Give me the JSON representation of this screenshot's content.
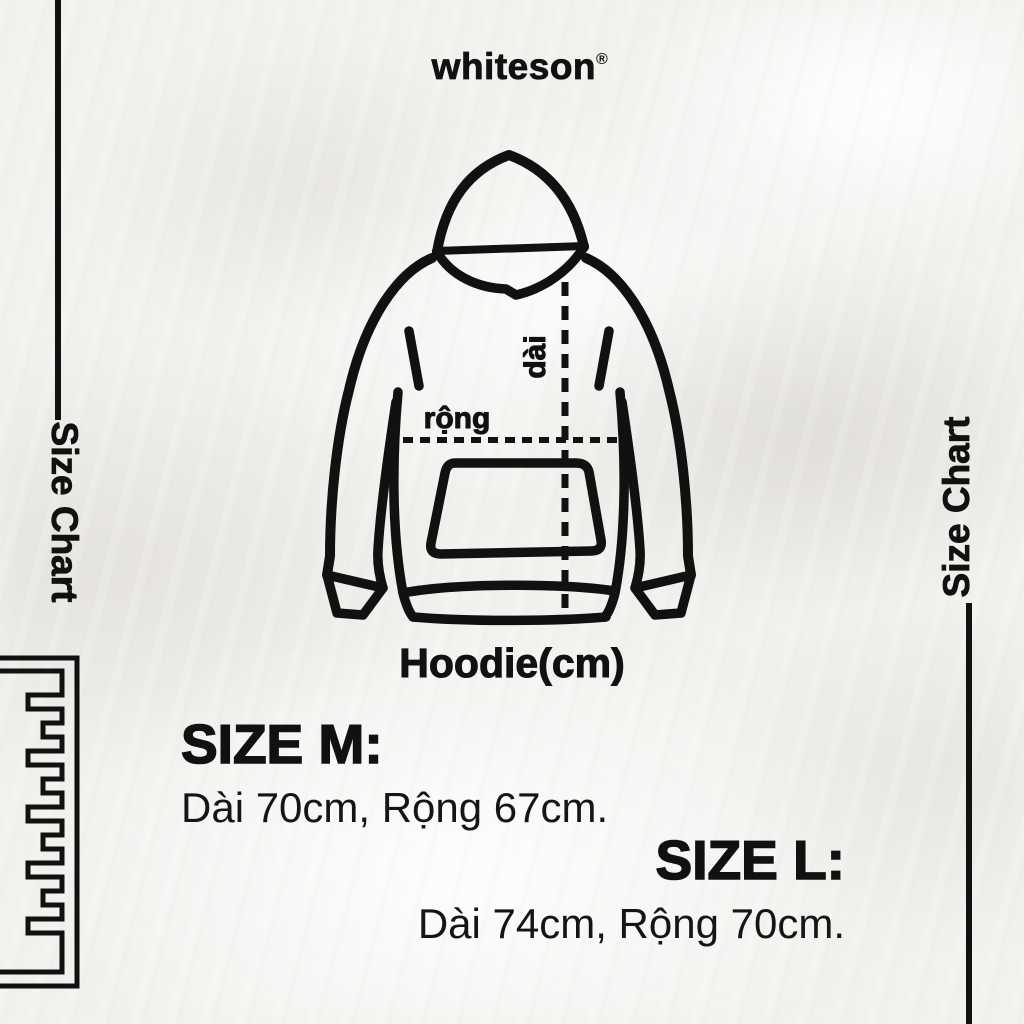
{
  "brand": {
    "name": "whiteson",
    "trademark_symbol": "®"
  },
  "rails": {
    "left_label": "Size Chart",
    "right_label": "Size Chart"
  },
  "diagram": {
    "caption": "Hoodie(cm)",
    "width_label": "rộng",
    "length_label": "dài"
  },
  "size_blocks": [
    {
      "title": "SIZE M:",
      "measurements": "Dài 70cm, Rộng 67cm."
    },
    {
      "title": "SIZE L:",
      "measurements": "Dài 74cm, Rộng 70cm."
    }
  ],
  "colors": {
    "ink": "#111111",
    "background": "#f2f1ee"
  }
}
